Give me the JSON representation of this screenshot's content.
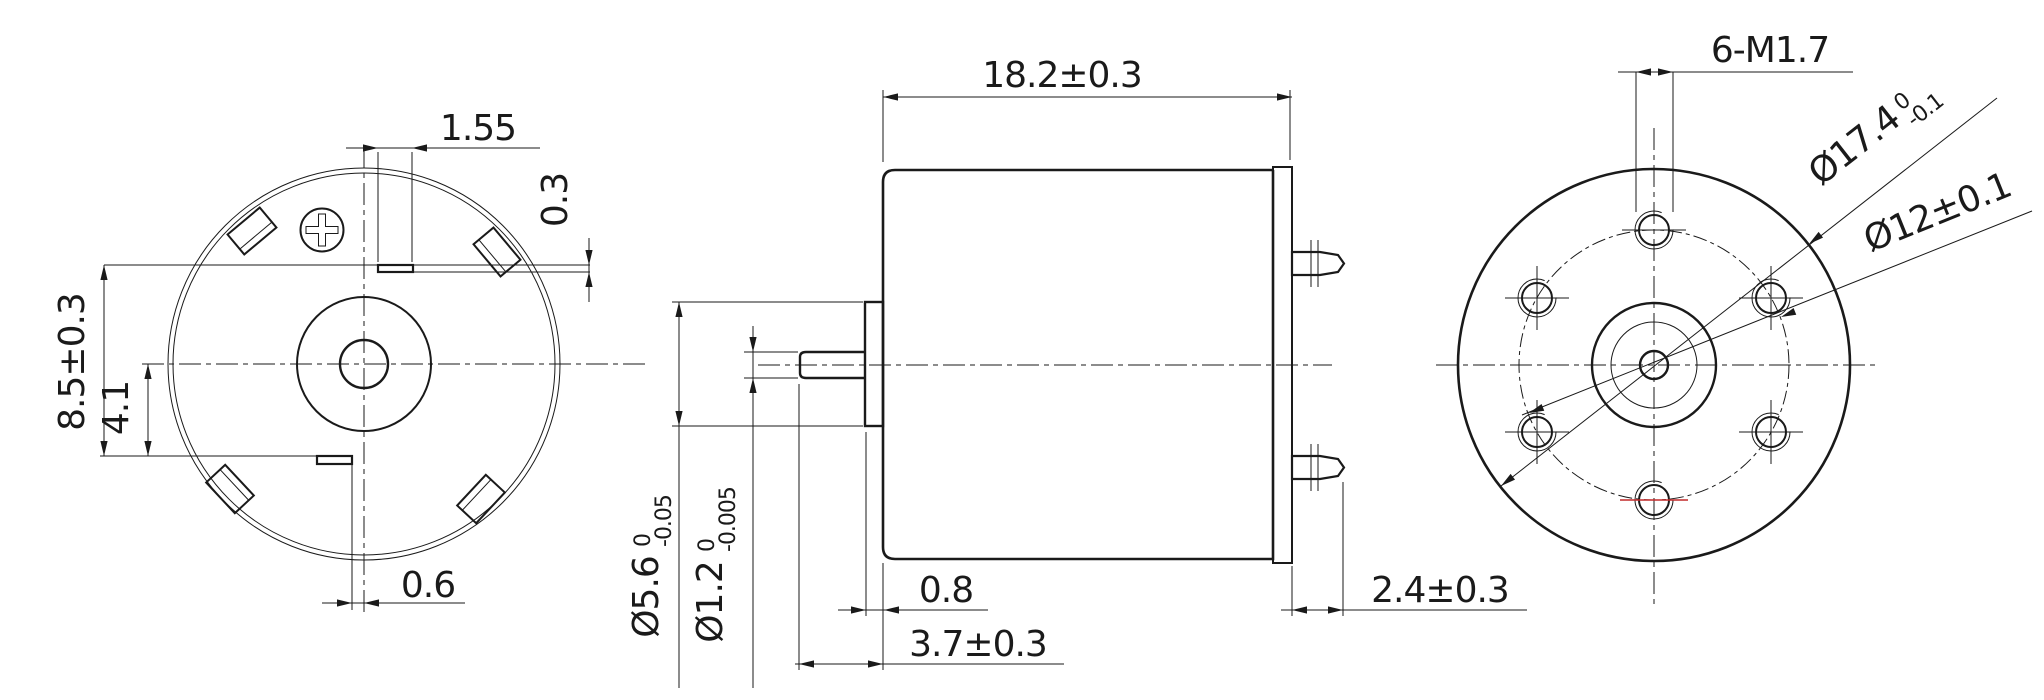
{
  "title": "micro dc motor engineering drawing",
  "colors": {
    "line": "#1a1a1a",
    "highlight": "#c22a2a",
    "background": "#ffffff"
  },
  "labels": {
    "front": {
      "slot_width": "1.55",
      "slot_depth": "0.3",
      "slot_span": "8.5±0.3",
      "center_to_slot": "4.1",
      "slot_offset": "0.6"
    },
    "side": {
      "body_length": "18.2±0.3",
      "boss_length": "0.8",
      "shaft_length": "3.7±0.3",
      "terminal_length": "2.4±0.3",
      "boss_dia": {
        "main": "Ø5.6",
        "upper": "0",
        "lower": "-0.05"
      },
      "shaft_dia": {
        "main": "Ø1.2",
        "upper": "0",
        "lower": "-0.005"
      }
    },
    "back": {
      "mount_holes": "6-M1.7",
      "outer_dia": {
        "main": "Ø17.4",
        "upper": "0",
        "lower": "-0.1"
      },
      "bolt_circle_dia": "Ø12±0.1"
    }
  }
}
